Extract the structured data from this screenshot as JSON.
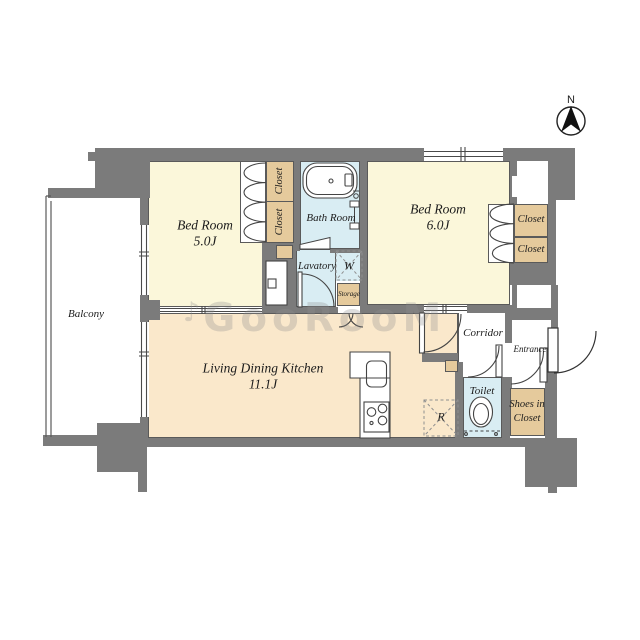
{
  "compass": {
    "north_label": "N"
  },
  "watermark": {
    "note": "♪",
    "text": "GooRooM"
  },
  "rooms": {
    "balcony": {
      "label": "Balcony"
    },
    "bedroom1": {
      "label": "Bed Room",
      "size": "5.0J"
    },
    "bedroom2": {
      "label": "Bed Room",
      "size": "6.0J"
    },
    "ldk": {
      "label": "Living Dining Kitchen",
      "size": "11.1J"
    },
    "bath": {
      "label": "Bath Room"
    },
    "lavatory": {
      "label": "Lavatory"
    },
    "toilet": {
      "label": "Toilet"
    },
    "corridor": {
      "label": "Corridor"
    },
    "entrance": {
      "label": "Entrance"
    },
    "shoes_closet": {
      "label_line1": "Shoes in",
      "label_line2": "Closet"
    },
    "storage": {
      "label": "Storage"
    }
  },
  "closets": {
    "bedroom1_upper": {
      "label": "Closet"
    },
    "bedroom1_lower": {
      "label": "Closet"
    },
    "bedroom2_upper": {
      "label": "Closet"
    },
    "bedroom2_lower": {
      "label": "Closet"
    }
  },
  "appliances": {
    "washing_machine": {
      "label": "W"
    },
    "refrigerator": {
      "label": "R"
    }
  },
  "colors": {
    "wall": "#7b7b7b",
    "bedroom_floor": "#fbf7da",
    "ldk_floor": "#fae8cb",
    "wet_area_floor": "#d9edf3",
    "closet_fill": "#e5ca9c"
  }
}
